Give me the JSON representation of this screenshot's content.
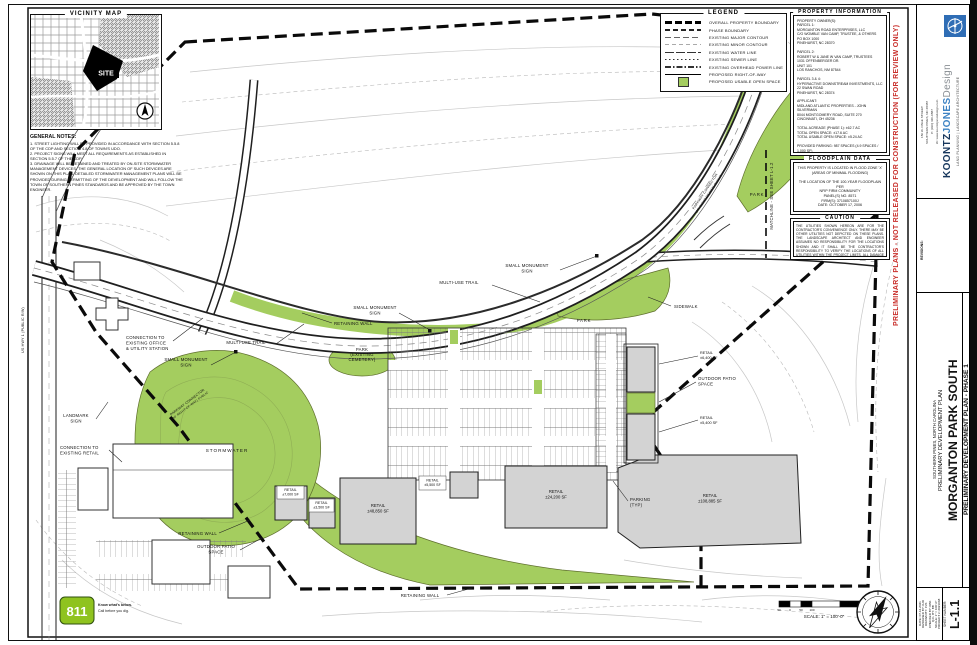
{
  "vicinity": {
    "title": "VICINITY MAP",
    "site": "SITE"
  },
  "general_notes": {
    "title": "GENERAL NOTES:",
    "notes": [
      "1. STREET LIGHTING WILL BE PROVIDED IN ACCORDANCE WITH SECTION 5.5.8 OF THE CDP AND SECTION 4.8 OF TOWN'S UDO.",
      "2. PROJECT SIGNS WILL MEET ALL REQUIREMENTS AS ESTABLISHED IN SECTION 5.5.7 OF THE CDP.",
      "3. DRAINAGE WILL BE RETAINED AND TREATED BY ON-SITE STORMWATER MANAGEMENT DEVICES. THE GENERAL LOCATION OF SUCH DEVICES ARE SHOWN ON THIS PLAN. DETAILED STORMWATER MANAGEMENT PLANS WILL BE PROVIDED DURING PERMITTING OF THE DEVELOPMENT AND WILL FOLLOW THE TOWN OF SOUTHERN PINES STANDARDS AND BE APPROVED BY THE TOWN ENGINEER."
    ]
  },
  "legend": {
    "title": "LEGEND",
    "items": [
      {
        "label": "OVERALL PROPERTY BOUNDARY"
      },
      {
        "label": "PHASE BOUNDARY"
      },
      {
        "label": "EXISTING MAJOR CONTOUR"
      },
      {
        "label": "EXISTING MINOR CONTOUR"
      },
      {
        "label": "EXISTING WATER LINE"
      },
      {
        "label": "EXISTING SEWER LINE"
      },
      {
        "label": "EXISTING OVERHEAD POWER LINE"
      },
      {
        "label": "PROPOSED RIGHT-OF-WAY"
      },
      {
        "label": "PROPOSED USABLE OPEN SPACE"
      }
    ]
  },
  "property_info": {
    "title": "PROPERTY INFORMATION",
    "lines": [
      "PROPERTY OWNER(S):",
      "PARCEL 1:",
      "MORGANTON ROAD ENTERPRISES, LLC",
      "C/O WOMBLE VAN CAMP, TRUSTEE, & OTHERS",
      "PO BOX 1000",
      "PINEHURST, NC 28370",
      "",
      "PARCEL 2:",
      "ROBERT W & JANE W VAN CAMP, TRUSTEES",
      "1031 OFFENBERGER DR.",
      "UNIT 101",
      "LOS RANCHOS, NM 87544",
      "",
      "PARCEL 3 & 4:",
      "HYPERACTIVE DOWNSTREAM INVESTMENTS, LLC",
      "22 SWAN ROAD",
      "PINEHURST, NC 28374",
      "",
      "APPLICANT:",
      "MIDLAND ATLANTIC PROPERTIES - JOHN SILVERMAN",
      "8044 MONTGOMERY ROAD, SUITE 270",
      "CINCINNATI, OH 45236",
      "",
      "TOTAL ACREAGE (PHASE 1): ±62.7 AC",
      "TOTAL OPEN SPACE: ±17.6 AC",
      "TOTAL USABLE OPEN SPACE: ±5.24 AC",
      "",
      "PROVIDED PARKING: 987 SPACES (4.9 SPACES / 1,000 SF)"
    ]
  },
  "floodplain": {
    "title": "FLOODPLAIN DATA",
    "lines": [
      "THIS PROPERTY IS LOCATED IN FLOOD ZONE 'X'",
      "(AREAS OF MINIMAL FLOODING)",
      "",
      "THE LOCATION OF THE 100-YEAR FLOODPLAIN PER",
      "NFIP FIRM COMMUNITY",
      "PANEL(S) NO. 8571",
      "FIRM(S): 3710857100J",
      "DATE: OCTOBER 17, 2006"
    ]
  },
  "caution": {
    "title": "CAUTION",
    "text": "THE UTILITIES SHOWN HEREON ARE FOR THE CONTRACTOR'S CONVENIENCE ONLY. THERE MAY BE OTHER UTILITIES NOT DEPICTED ON THESE PLANS. THE LANDSCAPE ARCHITECT AND ENGINEER ASSUMES NO RESPONSIBILITY FOR THE LOCATIONS SHOWN AND IT SHALL BE THE CONTRACTOR'S RESPONSIBILITY TO VERIFY THE LOCATIONS OF ALL UTILITIES WITHIN THE PROJECT LIMITS. ALL DAMAGE MADE TO THE EXISTING UTILITIES BY THE CONTRACTOR SHALL BE THE SOLE RESPONSIBILITY OF THE CONTRACTOR."
  },
  "warning": "PRELIMINARY PLANS - NOT RELEASED FOR CONSTRUCTION (FOR REVIEW ONLY)",
  "call811": {
    "number": "811",
    "line1": "Know what's below.",
    "line2": "Call before you dig."
  },
  "scalebar": {
    "label": "SCALE: 1\" = 100'-0\"",
    "ticks": [
      "50",
      "0",
      "50",
      "100",
      "200"
    ]
  },
  "plan": {
    "labels": {
      "small_monument_sign": [
        "SMALL MONUMENT",
        "SIGN"
      ],
      "multi_use_trail": "MULTI-USE TRAIL",
      "sidewalk": "SIDEWALK",
      "retaining_wall": "RETAINING WALL",
      "park": "PARK",
      "park_cemetery": [
        "PARK",
        "(EXISTING",
        "CEMETERY)"
      ],
      "stormwater": "STORMWATER",
      "landmark_sign": [
        "LANDMARK",
        "SIGN"
      ],
      "connection_office": [
        "CONNECTION TO",
        "EXISTING OFFICE",
        "& UTILITY STATION"
      ],
      "connection_retail": [
        "CONNECTION TO",
        "EXISTING RETAIL"
      ],
      "outdoor_patio": [
        "OUTDOOR PATIO",
        "SPACE"
      ],
      "parking_typ": [
        "PARKING",
        "(TYP)"
      ],
      "matchline": "MATCHLINE - SEE SHEET L-1.2",
      "parkway": [
        "PARKWAY CONNECTOR",
        "(80' RIGHT-OF-WAY) PUBLIC"
      ],
      "us1": "US HWY 1 (PUBLIC R/W)"
    },
    "buildings": [
      {
        "name": "RETAIL",
        "area": "±7,000 SF"
      },
      {
        "name": "RETAIL",
        "area": "±3,500 SF"
      },
      {
        "name": "RETAIL",
        "area": "±48,850 SF"
      },
      {
        "name": "RETAIL",
        "area": "±5,500 SF"
      },
      {
        "name": "RETAIL",
        "area": "±24,200 SF"
      },
      {
        "name": "RETAIL",
        "area": "±108,885 SF"
      },
      {
        "name": "RETAIL",
        "area": "±6,400 SF"
      },
      {
        "name": "RETAIL",
        "area": "±5,400 SF"
      }
    ]
  },
  "titleblock": {
    "firm": {
      "name1": "KOONTZ",
      "name2": "JONES",
      "name3": "Design",
      "tagline": "LAND PLANNING | LANDSCAPE ARCHITECTURE",
      "address": [
        "150 W. PAGE STREET",
        "SOUTHERN PINES, NC 28387",
        "P: (910) 420-0887",
        "W: www.koontzjonesdesign.com"
      ]
    },
    "revisions_label": "REVISIONS:",
    "project": {
      "name": "MORGANTON PARK SOUTH",
      "subtitle": "PRELIMINARY DEVELOPMENT PLAN",
      "location": "SOUTHERN PINES, NORTH CAROLINA"
    },
    "sheet_title": "PRELIMINARY DEVELOPMENT PLAN - PHASE 1",
    "info": [
      "DATE: 07.12.2021",
      "DESIGNED BY: KJD",
      "DRAWN BY: PJS",
      "CHECKED BY: KBK",
      "Q.C. BY: BB",
      "SCALE: 1\" = 100'-0\"",
      "PROJECT #: 2021068"
    ],
    "sheet_number_label": "SHEET NUMBER:",
    "sheet_number": "L-1.1"
  }
}
